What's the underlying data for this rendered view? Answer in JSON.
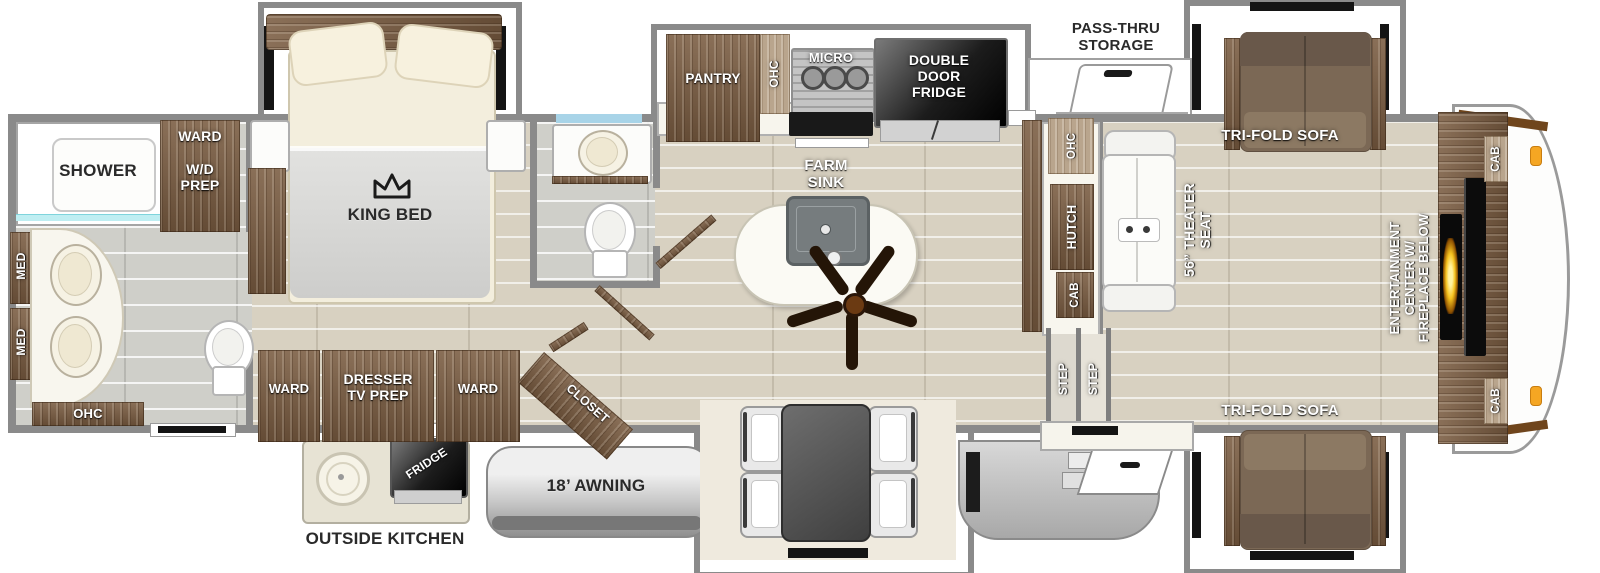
{
  "floorplan": {
    "type": "rv-fifth-wheel-floorplan",
    "colors": {
      "wall": "#8a8a8a",
      "wood": "#7a5c41",
      "floor_plank": "#d8d1c1",
      "floor_tile": "#cfcfc9",
      "fireplace_glow": "#f6c31f",
      "marker_light": "#f5a623",
      "mirror_glass": "#a8d4e8",
      "label_white": "#ffffff",
      "label_dark": "#2a2a2a"
    },
    "rooms": {
      "rear_bath": {
        "shower": "SHOWER",
        "med_upper": "MED",
        "med_lower": "MED",
        "ohc": "OHC",
        "ward": "WARD",
        "wd_prep": "W/D\nPREP"
      },
      "bedroom": {
        "bed": "KING BED",
        "ward_left": "WARD",
        "dresser": "DRESSER\nTV PREP",
        "ward_right": "WARD",
        "closet": "CLOSET"
      },
      "kitchen": {
        "pantry": "PANTRY",
        "ohc": "OHC",
        "micro": "MICRO",
        "fridge": "DOUBLE\nDOOR\nFRIDGE",
        "island": "FARM\nSINK"
      },
      "living": {
        "sofa_top": "TRI-FOLD SOFA",
        "sofa_bottom": "TRI-FOLD SOFA",
        "ohc": "OHC",
        "hutch": "HUTCH",
        "cab": "CAB",
        "theater": "56” THEATER\nSEAT",
        "step_left": "STEP",
        "step_right": "STEP",
        "entertainment": "ENTERTAINMENT\nCENTER W/\nFIREPLACE BELOW",
        "cab_front_top": "CAB",
        "cab_front_bottom": "CAB"
      },
      "exterior": {
        "pass_thru": "PASS-THRU\nSTORAGE",
        "outside_kitchen": "OUTSIDE KITCHEN",
        "outside_fridge": "FRIDGE",
        "awning": "18’ AWNING"
      }
    }
  }
}
